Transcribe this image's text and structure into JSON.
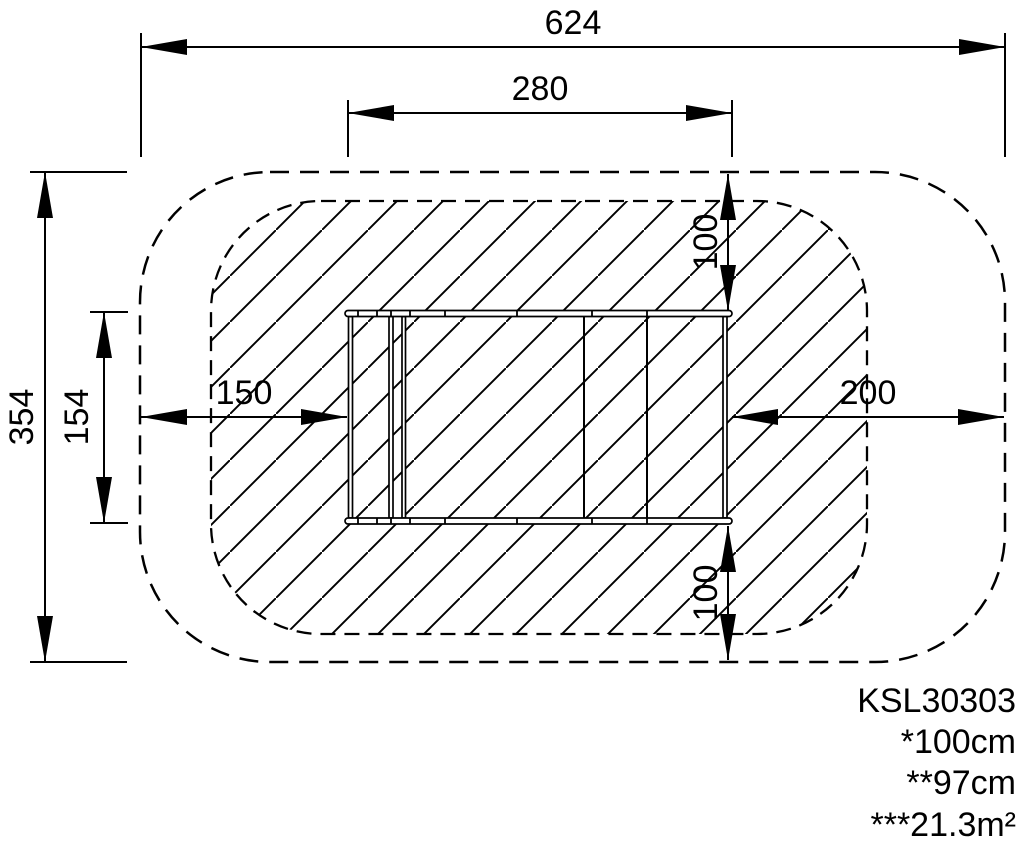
{
  "drawing": {
    "product_code": "KSL30303",
    "notes": [
      "*100cm",
      "**97cm",
      "***21.3m²"
    ],
    "dimensions": {
      "overall_width": "624",
      "inner_width": "280",
      "overall_depth": "354",
      "inner_depth": "154",
      "left_clearance": "150",
      "right_clearance": "200",
      "top_clearance": "100",
      "bottom_clearance": "100"
    },
    "colors": {
      "ink": "#000000",
      "paper": "#ffffff"
    }
  }
}
